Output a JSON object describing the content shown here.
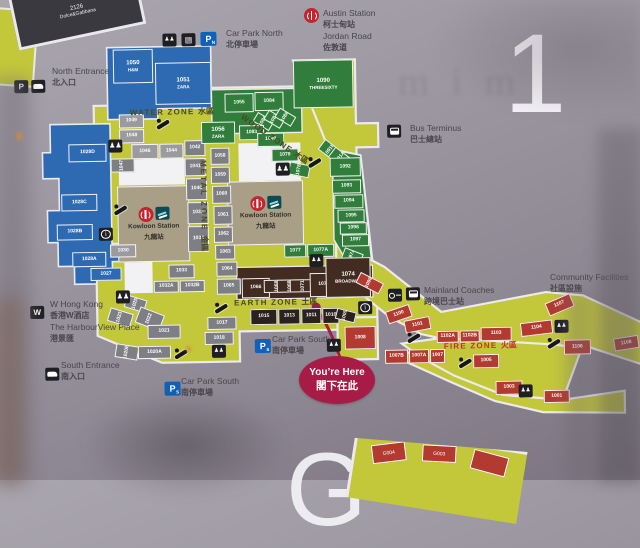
{
  "floor_indicator": {
    "current": "1",
    "below_partial": "G"
  },
  "ghost_reflection": "mim",
  "zone_labels": {
    "water": {
      "en": "WATER ZONE",
      "cn": "水區"
    },
    "wood": {
      "en": "WOOD ZONE",
      "cn": "木區"
    },
    "metal": {
      "en": "METAL ZONE",
      "cn": "金區"
    },
    "earth": {
      "en": "EARTH ZONE",
      "cn": "土區"
    },
    "fire": {
      "en": "FIRE ZONE",
      "cn": "火區"
    }
  },
  "landmarks": {
    "austin_station": {
      "line1": "Austin Station",
      "line2": "柯士甸站",
      "line3": "Jordan Road",
      "line4": "佐敦道"
    },
    "car_park_north": {
      "en": "Car Park North",
      "cn": "北停車場"
    },
    "north_entrance": {
      "en": "North Entrance",
      "cn": "北入口"
    },
    "bus_terminus": {
      "en": "Bus Terminus",
      "cn": "巴士總站"
    },
    "mainland_coaches": {
      "en": "Mainland Coaches",
      "cn": "跨境巴士站"
    },
    "community_facilities": {
      "en": "Community Facilities",
      "cn": "社區設施"
    },
    "w_hong_kong": {
      "line1": "W Hong Kong",
      "line2": "香港W酒店",
      "line3": "The HarbourView Place",
      "line4": "港景匯"
    },
    "south_entrance": {
      "en": "South Entrance",
      "cn": "南入口"
    },
    "car_park_south": {
      "en": "Car Park South",
      "cn": "南停車場"
    },
    "car_park_south_2": {
      "en": "Car Park South",
      "cn": "南停車場"
    },
    "kowloon_station": {
      "en": "Kowloon Station",
      "cn": "九龍站"
    },
    "youre_here": {
      "en": "You’re Here",
      "cn": "閣下在此"
    }
  },
  "adjacent_map_fragments": {
    "top_left_unit": {
      "label": "2126",
      "sub": "Dolce&Gabbana"
    },
    "bottom_left_units": [
      "G004",
      "G003"
    ]
  },
  "colors": {
    "walkway": "#c3c73a",
    "water_zone": "#2e6ab2",
    "wood_zone": "#317d3c",
    "metal_zone": "#7e7e85",
    "earth_zone": "#422b21",
    "fire_zone": "#b23a30",
    "station_block": "#a89f86",
    "youre_here": "#a81b47",
    "mtr_red": "#c32430",
    "parking_blue": "#1261b8"
  },
  "units": [
    [
      "1050",
      "water",
      116,
      46,
      40,
      34,
      0,
      "H&M"
    ],
    [
      "1051",
      "water",
      158,
      60,
      56,
      42,
      0,
      "ZARA"
    ],
    [
      "1028D",
      "water",
      70,
      140,
      38,
      18,
      0,
      null
    ],
    [
      "1028C",
      "water",
      62,
      190,
      36,
      17,
      0,
      null
    ],
    [
      "1028B",
      "water",
      57,
      220,
      36,
      16,
      0,
      null
    ],
    [
      "1028A",
      "water",
      72,
      248,
      34,
      15,
      0,
      null
    ],
    [
      "1027",
      "water",
      90,
      264,
      31,
      13,
      0,
      null
    ],
    [
      "1049",
      "metal_light",
      121,
      111,
      25,
      14,
      0,
      null
    ],
    [
      "1048",
      "metal_light",
      121,
      126,
      25,
      14,
      0,
      null
    ],
    [
      "1046",
      "metal_light",
      133,
      141,
      27,
      15,
      0,
      null
    ],
    [
      "1044",
      "metal_light",
      161,
      141,
      24,
      15,
      0,
      null
    ],
    [
      "1047",
      "metal",
      117,
      150,
      14,
      24,
      -90,
      null
    ],
    [
      "1030",
      "metal_light",
      110,
      241,
      26,
      13,
      0,
      null
    ],
    [
      "1042",
      "metal",
      186,
      138,
      21,
      16,
      0,
      null
    ],
    [
      "1041",
      "metal",
      186,
      156,
      21,
      18,
      0,
      null
    ],
    [
      "1040",
      "metal",
      187,
      176,
      21,
      22,
      0,
      null
    ],
    [
      "1038",
      "metal",
      188,
      200,
      21,
      22,
      0,
      null
    ],
    [
      "1034",
      "metal",
      188,
      224,
      21,
      26,
      0,
      null
    ],
    [
      "1058",
      "metal",
      212,
      146,
      19,
      17,
      0,
      null
    ],
    [
      "1059",
      "metal",
      212,
      165,
      19,
      17,
      0,
      null
    ],
    [
      "1060",
      "metal",
      213,
      184,
      19,
      18,
      0,
      null
    ],
    [
      "1061",
      "metal",
      214,
      204,
      19,
      19,
      0,
      null
    ],
    [
      "1062",
      "metal",
      214,
      225,
      19,
      16,
      0,
      null
    ],
    [
      "1063",
      "metal",
      215,
      243,
      20,
      15,
      0,
      null
    ],
    [
      "1064",
      "metal",
      216,
      260,
      21,
      15,
      0,
      null
    ],
    [
      "1065",
      "metal",
      216,
      277,
      24,
      16,
      0,
      null
    ],
    [
      "1033",
      "metal",
      168,
      262,
      26,
      14,
      0,
      null
    ],
    [
      "1032A",
      "metal",
      153,
      278,
      25,
      12,
      0,
      null
    ],
    [
      "1032B",
      "metal",
      179,
      278,
      25,
      12,
      0,
      null
    ],
    [
      "1023",
      "metal",
      112,
      302,
      14,
      24,
      -72,
      null
    ],
    [
      "1025",
      "metal",
      128,
      290,
      13,
      21,
      -72,
      null
    ],
    [
      "1022",
      "metal",
      140,
      303,
      17,
      26,
      -68,
      null
    ],
    [
      "1021",
      "metal",
      146,
      322,
      33,
      14,
      0,
      null
    ],
    [
      "1020B",
      "metal",
      118,
      337,
      14,
      23,
      -80,
      null
    ],
    [
      "1020A",
      "metal",
      136,
      343,
      33,
      13,
      0,
      null
    ],
    [
      "1017",
      "metal",
      206,
      315,
      29,
      13,
      0,
      null
    ],
    [
      "1018",
      "metal",
      203,
      330,
      29,
      13,
      0,
      null
    ],
    [
      "1055",
      "wood",
      227,
      92,
      29,
      19,
      0,
      null
    ],
    [
      "1084",
      "wood",
      257,
      91,
      29,
      19,
      0,
      null
    ],
    [
      "1086",
      "wood",
      260,
      111,
      11,
      19,
      -58,
      null
    ],
    [
      "1087",
      "wood",
      271,
      109,
      11,
      19,
      -58,
      null
    ],
    [
      "1088",
      "wood",
      282,
      107,
      11,
      19,
      -58,
      null
    ],
    [
      "1056",
      "wood",
      203,
      120,
      34,
      22,
      0,
      "ZARA"
    ],
    [
      "1083",
      "wood",
      241,
      124,
      25,
      15,
      0,
      null
    ],
    [
      "1090",
      "wood",
      296,
      60,
      60,
      48,
      0,
      "THREESIXTY"
    ],
    [
      "1080",
      "wood",
      259,
      132,
      27,
      14,
      0,
      null
    ],
    [
      "1079",
      "wood",
      273,
      148,
      27,
      13,
      0,
      null
    ],
    [
      "1078",
      "wood",
      294,
      159,
      13,
      21,
      -78,
      null
    ],
    [
      "1091B",
      "wood",
      325,
      140,
      13,
      21,
      -52,
      null
    ],
    [
      "1091A",
      "wood",
      335,
      148,
      13,
      21,
      -52,
      null
    ],
    [
      "1092",
      "wood",
      331,
      158,
      31,
      19,
      0,
      null
    ],
    [
      "1093",
      "wood",
      333,
      180,
      29,
      14,
      0,
      null
    ],
    [
      "1094",
      "wood",
      335,
      195,
      29,
      14,
      0,
      null
    ],
    [
      "1095",
      "wood",
      338,
      210,
      27,
      13,
      0,
      null
    ],
    [
      "1096",
      "wood",
      340,
      223,
      27,
      12,
      0,
      null
    ],
    [
      "1097",
      "wood",
      342,
      235,
      27,
      12,
      0,
      null
    ],
    [
      "1097A",
      "wood",
      346,
      247,
      12,
      20,
      -68,
      null
    ],
    [
      "1077",
      "wood",
      284,
      244,
      22,
      13,
      0,
      null
    ],
    [
      "1077A",
      "wood",
      307,
      244,
      27,
      13,
      0,
      null
    ],
    [
      "1066",
      "earth",
      241,
      277,
      28,
      20,
      0,
      null
    ],
    [
      "1068",
      "earth",
      270,
      272,
      13,
      27,
      -90,
      null
    ],
    [
      "1069",
      "earth",
      283,
      272,
      13,
      27,
      -90,
      null
    ],
    [
      "1071",
      "earth",
      296,
      272,
      13,
      27,
      -90,
      null
    ],
    [
      "1072",
      "earth",
      309,
      273,
      28,
      24,
      0,
      null
    ],
    [
      "1074",
      "earth",
      325,
      258,
      45,
      40,
      0,
      "BROADWAY"
    ],
    [
      "1015",
      "earth_dark",
      249,
      308,
      27,
      16,
      0,
      null
    ],
    [
      "1013",
      "earth_dark",
      277,
      308,
      22,
      16,
      0,
      null
    ],
    [
      "1011",
      "earth_dark",
      300,
      308,
      20,
      16,
      0,
      null
    ],
    [
      "1010",
      "earth_dark",
      321,
      308,
      17,
      16,
      0,
      null
    ],
    [
      "1009",
      "earth_dark",
      339,
      306,
      11,
      20,
      -75,
      null
    ],
    [
      "1008",
      "fire",
      343,
      327,
      31,
      23,
      0,
      null
    ],
    [
      "1007B",
      "fire",
      383,
      351,
      23,
      14,
      0,
      null
    ],
    [
      "1007A",
      "fire",
      407,
      351,
      20,
      14,
      0,
      null
    ],
    [
      "1007",
      "fire",
      428,
      351,
      15,
      14,
      0,
      null
    ],
    [
      "1098",
      "fire",
      363,
      271,
      12,
      26,
      -62,
      null
    ],
    [
      "1100",
      "fire",
      385,
      309,
      25,
      13,
      -18,
      null
    ],
    [
      "1101",
      "fire",
      403,
      320,
      26,
      13,
      -10,
      null
    ],
    [
      "1102A",
      "fire",
      435,
      333,
      22,
      12,
      0,
      null
    ],
    [
      "1102B",
      "fire",
      458,
      333,
      20,
      12,
      0,
      null
    ],
    [
      "1103",
      "fire",
      479,
      330,
      31,
      14,
      0,
      null
    ],
    [
      "1104",
      "fire",
      519,
      325,
      32,
      14,
      -6,
      null
    ],
    [
      "1107",
      "fire",
      545,
      302,
      27,
      14,
      -22,
      null
    ],
    [
      "1106",
      "fire",
      562,
      344,
      27,
      15,
      0,
      null
    ],
    [
      "1108",
      "fire",
      612,
      342,
      25,
      13,
      -8,
      null
    ],
    [
      "1005",
      "fire",
      471,
      357,
      26,
      14,
      0,
      null
    ],
    [
      "1003",
      "fire",
      493,
      384,
      27,
      14,
      0,
      null
    ],
    [
      "1001",
      "fire",
      541,
      394,
      26,
      13,
      0,
      null
    ]
  ],
  "map_icons": [
    [
      "lift",
      166,
      31
    ],
    [
      "ticket",
      185,
      31
    ],
    [
      "parking-n",
      204,
      30
    ],
    [
      "parking-black",
      17,
      75
    ],
    [
      "car",
      34,
      75
    ],
    [
      "escalator",
      157,
      116
    ],
    [
      "toilets",
      110,
      136
    ],
    [
      "escalator",
      113,
      201
    ],
    [
      "info",
      99,
      224
    ],
    [
      "escalator",
      308,
      157
    ],
    [
      "toilets",
      277,
      162
    ],
    [
      "bus",
      389,
      126
    ],
    [
      "toilets",
      115,
      287
    ],
    [
      "escalator",
      171,
      346
    ],
    [
      "lift",
      210,
      343
    ],
    [
      "escalator",
      212,
      301
    ],
    [
      "info",
      357,
      302
    ],
    [
      "lift",
      309,
      254
    ],
    [
      "parking-s",
      253,
      338
    ],
    [
      "lift",
      325,
      339
    ],
    [
      "parking-s",
      162,
      379
    ],
    [
      "car",
      43,
      363
    ],
    [
      "w",
      29,
      301
    ],
    [
      "key",
      387,
      290
    ],
    [
      "coach",
      405,
      289
    ],
    [
      "escalator",
      455,
      360
    ],
    [
      "escalator",
      404,
      334
    ],
    [
      "escalator",
      544,
      342
    ],
    [
      "lift",
      553,
      324
    ],
    [
      "lift",
      516,
      388
    ]
  ]
}
